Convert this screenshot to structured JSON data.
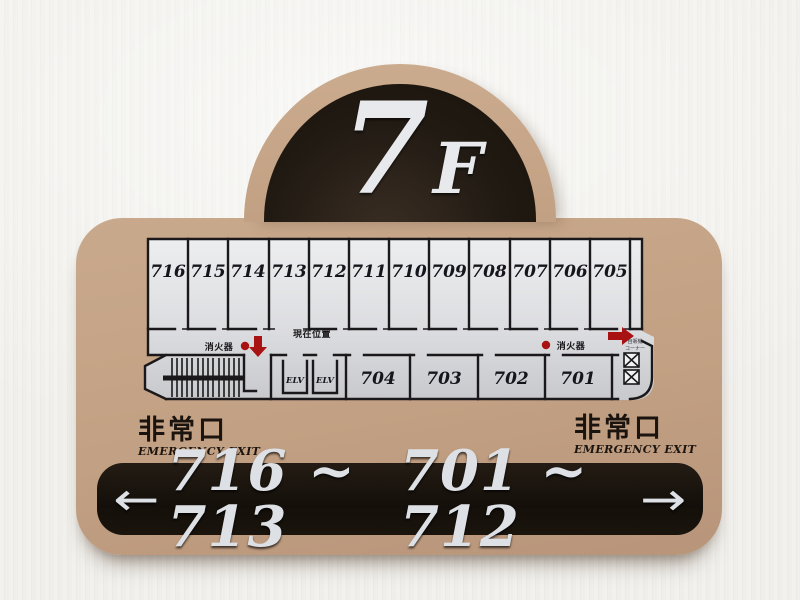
{
  "floor": {
    "number": "7",
    "suffix": "F"
  },
  "plan": {
    "top_rooms": [
      "716",
      "715",
      "714",
      "713",
      "712",
      "711",
      "710",
      "709",
      "708",
      "707",
      "706",
      "705"
    ],
    "bottom_rooms": [
      "704",
      "703",
      "702",
      "701"
    ],
    "elevator_label": "ELV",
    "current_location": "現在位置",
    "fire_extinguisher": "消火器",
    "vending_line1": "自販機",
    "vending_line2": "コーナー"
  },
  "exits": {
    "left": {
      "jp": "非常口",
      "en": "EMERGENCY EXIT"
    },
    "right": {
      "jp": "非常口",
      "en": "EMERGENCY EXIT"
    }
  },
  "bar": {
    "left_arrow": "←",
    "left_range": "716 ~ 713",
    "right_range": "701 ~ 712",
    "right_arrow": "→"
  },
  "colors": {
    "sign_beige": "#c2a083",
    "dome_dark": "#201913",
    "bar_dark": "#17110c",
    "silver_text": "#dde0e5",
    "marker_red": "#a81212",
    "plan_panel": "#d9dadd"
  }
}
